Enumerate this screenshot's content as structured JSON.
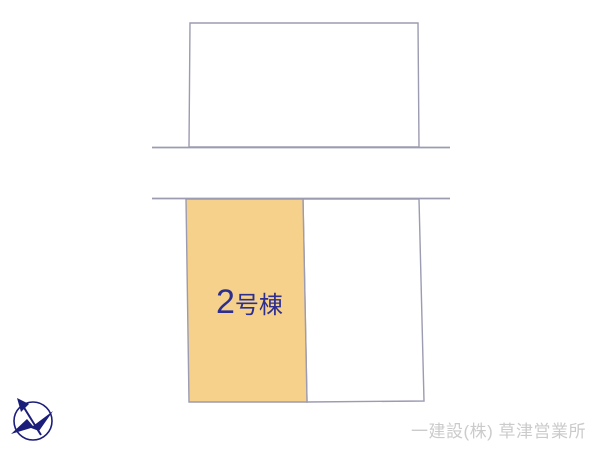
{
  "plan": {
    "building_label": {
      "number": "2",
      "suffix": "号棟"
    }
  },
  "footer": {
    "company_name": "一建設(株) 草津営業所"
  },
  "icons": {
    "compass": "compass-north-arrow-icon"
  },
  "colors": {
    "background": "#FFFFFF",
    "plot_outline": "#9B9BB1",
    "highlight_parcel_fill": "#F6D18C",
    "building_label_text": "#2D2E8E",
    "company_text": "#CBCBCB",
    "compass_navy": "#1B1D7A"
  }
}
